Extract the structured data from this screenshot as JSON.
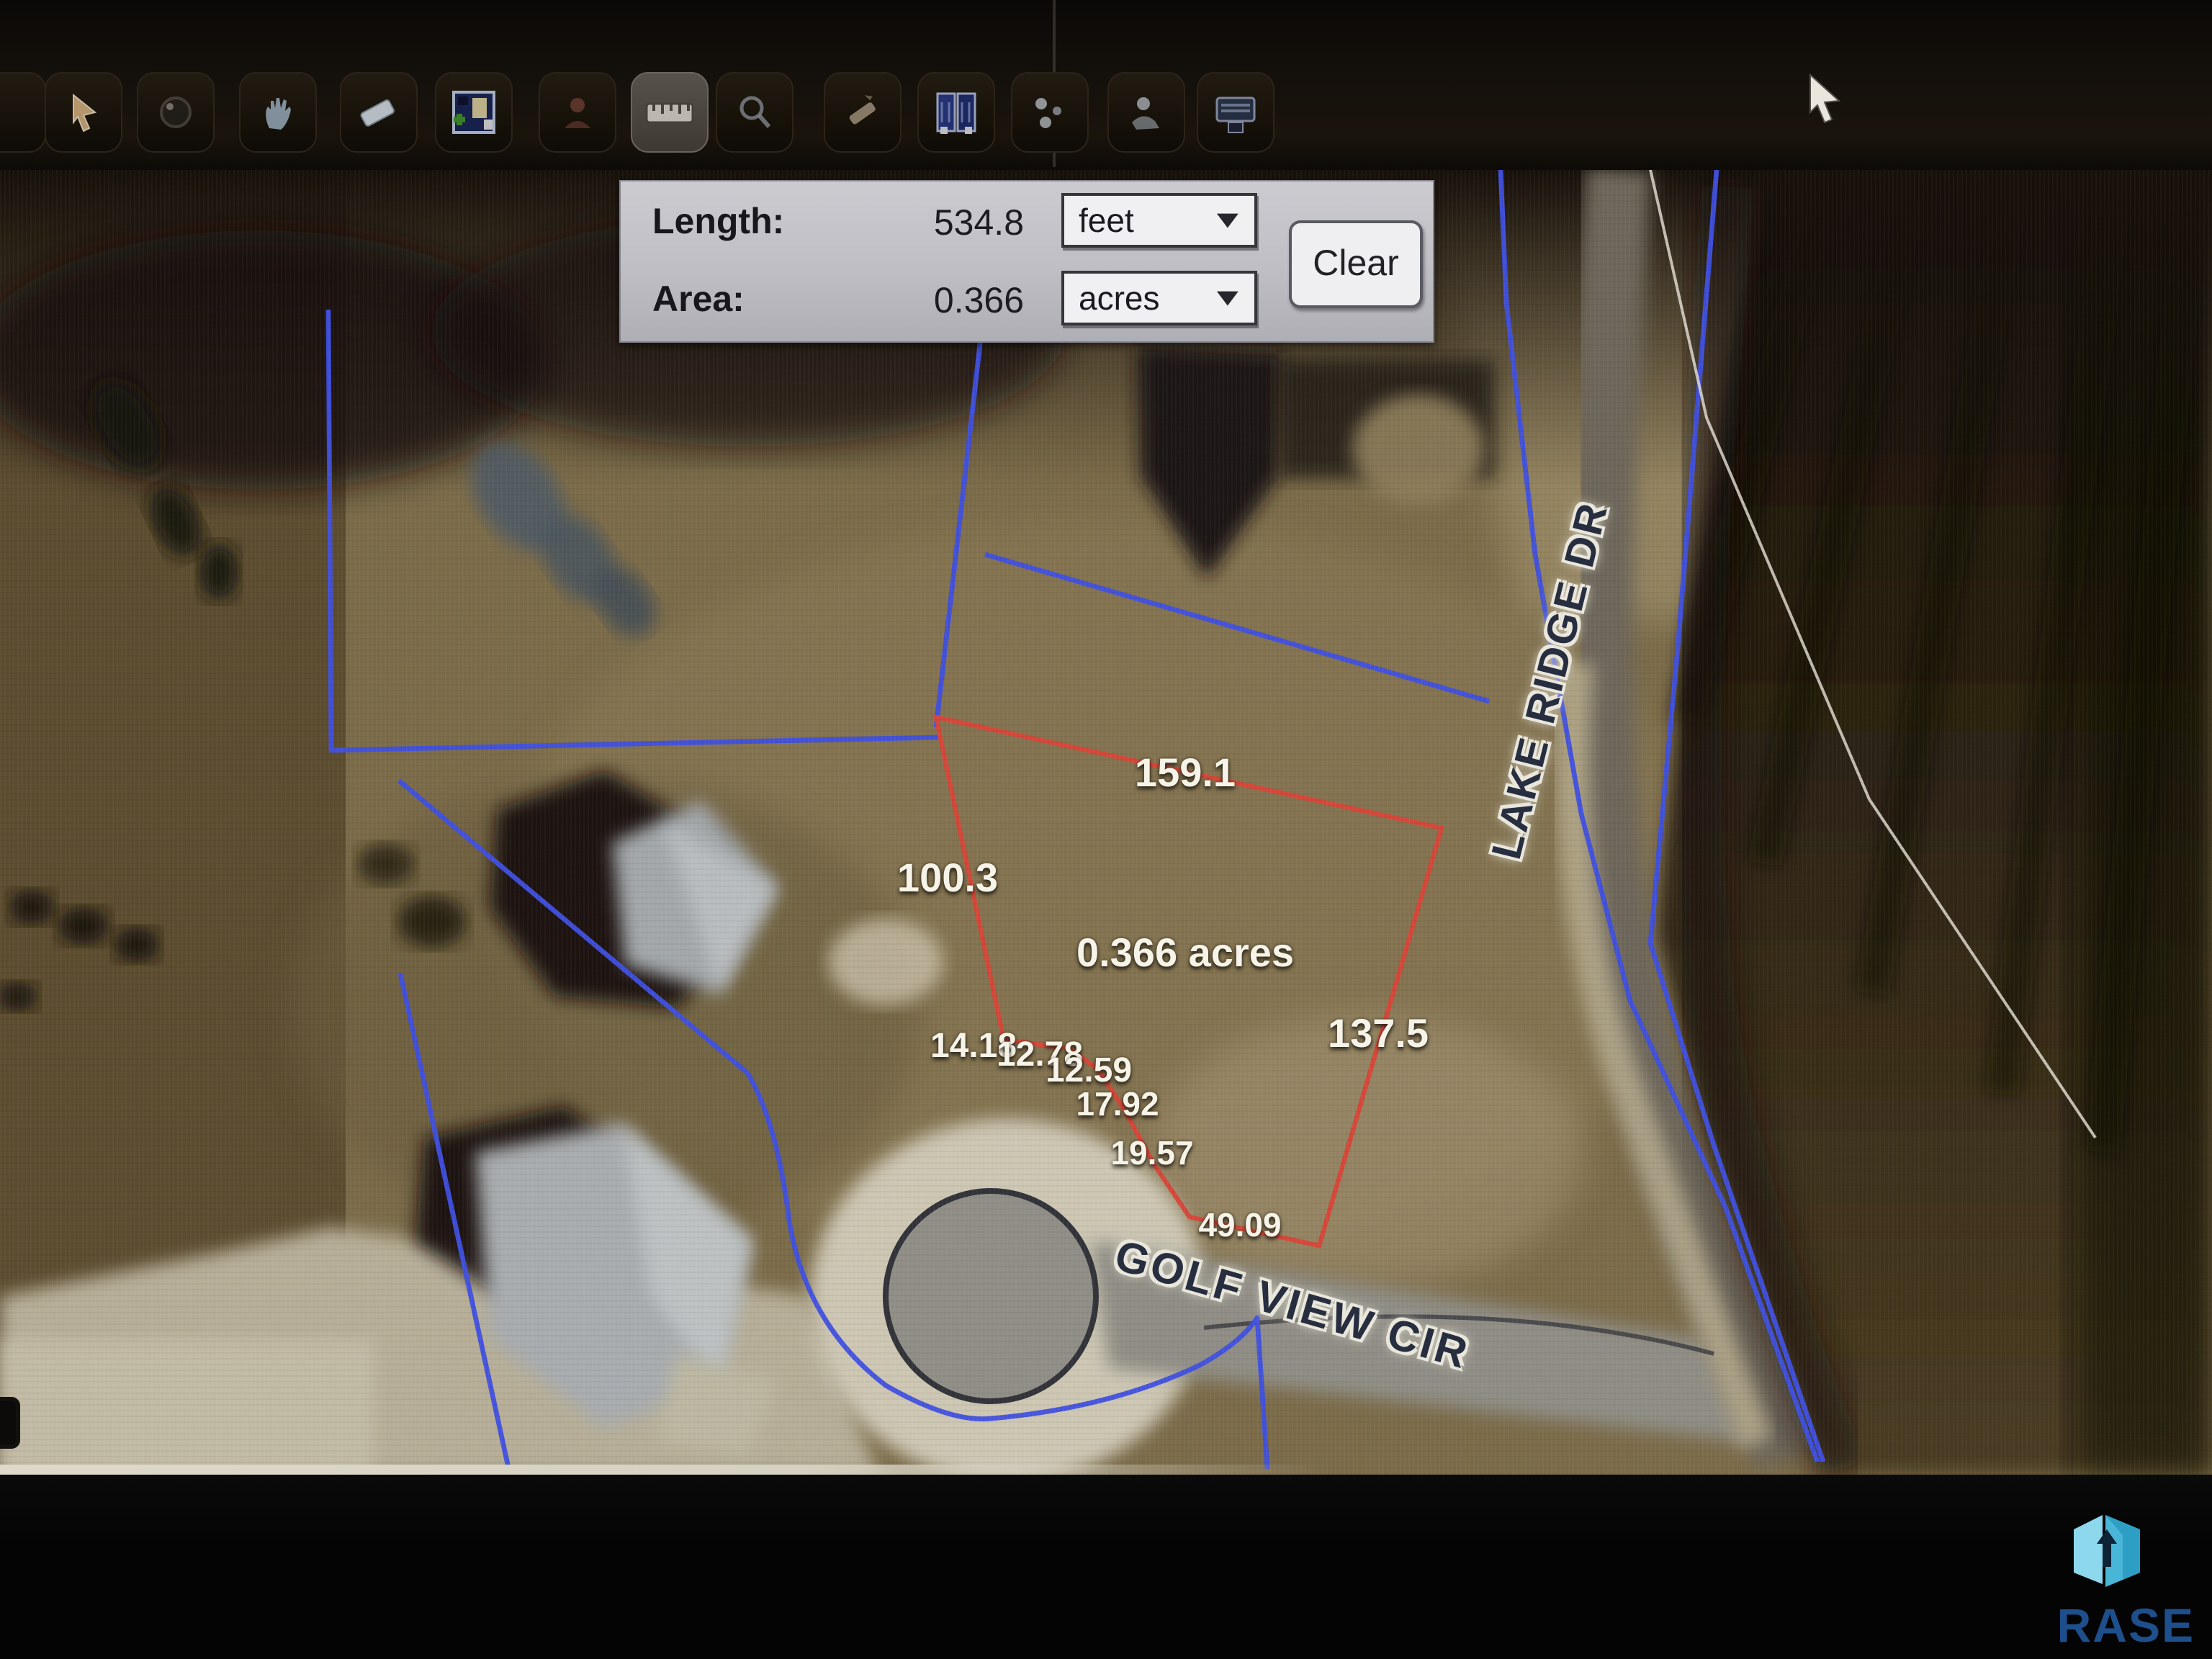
{
  "toolbar": {
    "icons": [
      {
        "name": "partial-tool"
      },
      {
        "name": "select-cursor-tool"
      },
      {
        "name": "zoom-globe-tool"
      },
      {
        "name": "pan-hand-tool"
      },
      {
        "name": "eraser-tool"
      },
      {
        "name": "add-map-view-tool"
      },
      {
        "name": "identify-tool"
      },
      {
        "name": "measure-ruler-tool"
      },
      {
        "name": "search-magnifier-tool"
      },
      {
        "name": "draw-pencil-tool"
      },
      {
        "name": "layers-book-tool"
      },
      {
        "name": "markup-points-tool"
      },
      {
        "name": "profile-person-tool"
      },
      {
        "name": "print-tool"
      }
    ]
  },
  "measure_panel": {
    "length_label": "Length:",
    "length_value": "534.8",
    "length_unit": "feet",
    "area_label": "Area:",
    "area_value": "0.366",
    "area_unit": "acres",
    "clear_label": "Clear",
    "chevron": "▼"
  },
  "map": {
    "area_label": "0.366 acres",
    "segment_labels": [
      {
        "text": "159.1"
      },
      {
        "text": "100.3"
      },
      {
        "text": "137.5"
      },
      {
        "text": "14.18"
      },
      {
        "text": "12.78"
      },
      {
        "text": "12.59"
      },
      {
        "text": "17.92"
      },
      {
        "text": "19.57"
      },
      {
        "text": "49.09"
      }
    ],
    "streets": {
      "lake_ridge": "LAKE RIDGE DR",
      "golf_view": "GOLF VIEW CIR"
    },
    "colors": {
      "parcel_blue": "#4050e0",
      "measure_red": "#d84438",
      "label_white": "#f6f3e8",
      "street_navy": "#272e40"
    }
  },
  "watermark": {
    "text": "RASE",
    "icon": "box-arrow-logo",
    "colors": {
      "light_blue": "#8ed8ee",
      "mid_blue": "#2e9fc4",
      "text_blue": "#1d4f8d"
    }
  }
}
